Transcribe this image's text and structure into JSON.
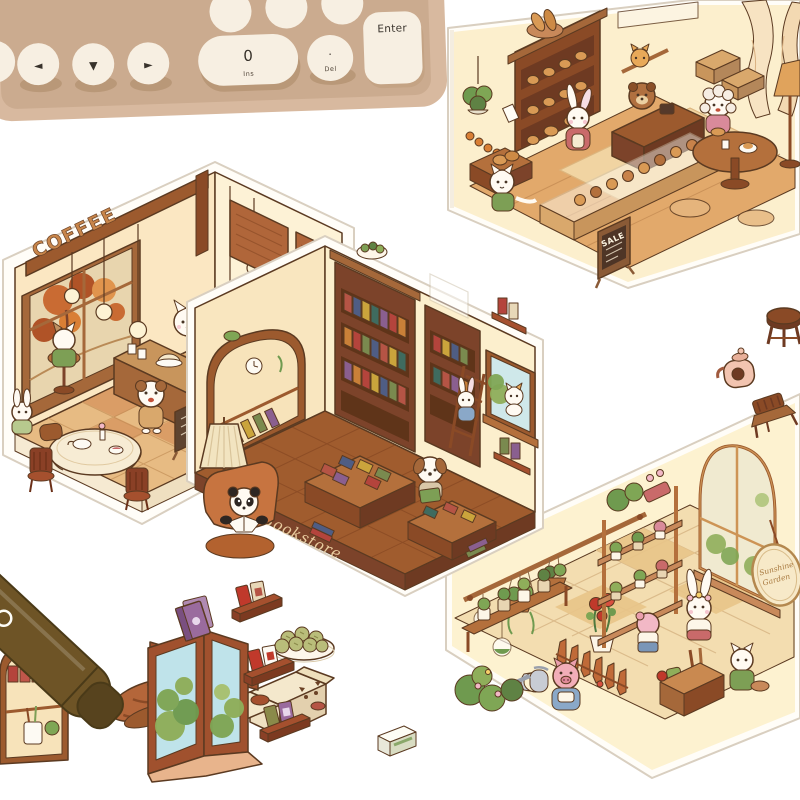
{
  "photo": {
    "background": "#ffffff"
  },
  "keyboard": {
    "body_color": "#d8b99f",
    "key_color": "#f7efe2",
    "arrow_keys": [
      "◄",
      "▼",
      "►"
    ],
    "zero_key": {
      "label": "0",
      "sublabel": "Ins"
    },
    "dot_key": {
      "label": ".",
      "sublabel": "Del"
    },
    "enter_key": {
      "label": "Enter"
    }
  },
  "rooms": {
    "coffee_shop": {
      "sign": "COFFEE",
      "characters": [
        "white cat barista",
        "cat in green sweater",
        "white dog customer",
        "white rabbit at table"
      ],
      "features": [
        "autumn window",
        "hanging bulbs",
        "menu shutters",
        "espresso machine",
        "bar counter",
        "round table with tablecloth",
        "wooden chairs",
        "menu board",
        "potted plant"
      ]
    },
    "bookstore": {
      "sign": "Bookstore",
      "characters": [
        "panda reading in armchair",
        "beagle dog reading",
        "white cat in window",
        "rabbit by ladder"
      ],
      "features": [
        "arched display shelf",
        "pleated floor lamp",
        "bookshelves",
        "succulent bowl",
        "book display tables",
        "window with bush",
        "red wall shelves"
      ]
    },
    "bakery": {
      "board": "SALE",
      "characters": [
        "bear cashier",
        "pink rabbit shopper",
        "white cat clerk",
        "poodle at table",
        "orange cat on shelf"
      ],
      "features": [
        "bread shelves",
        "hanging plant",
        "glass pastry display",
        "round table",
        "curtains",
        "floor lamp",
        "bread crate"
      ]
    },
    "garden_shop": {
      "sign_line1": "Sunshine",
      "sign_line2": "Garden",
      "characters": [
        "pink pig with watering can",
        "white rabbit with flower crown",
        "pink piglet",
        "white cat gardener"
      ],
      "features": [
        "hanging planters",
        "glass terrariums",
        "plant shelves",
        "arched window",
        "oval sign",
        "picket fence",
        "garden crate",
        "rose pot",
        "flowering bushes"
      ]
    }
  },
  "stickers": [
    "marker pen",
    "striped stand",
    "plate of matcha buns",
    "cardboard boxes with cat face",
    "small box",
    "corner window with bushes",
    "purple books",
    "mini book shelf top",
    "mini book shelf middle",
    "mini book shelf bottom",
    "wooden stool",
    "pink teapot",
    "wooden chair",
    "arched stationery cabinet"
  ],
  "palette": {
    "outline": "#5b3a21",
    "wall_cream": "#fcefcd",
    "wood": "#a5683a",
    "wood_dark": "#7c432a",
    "floor_tan": "#e3b077",
    "leaf_green": "#6f9a4f",
    "autumn_orange": "#c96b33",
    "sky_blue": "#bfe3ea",
    "blush_pink": "#f2b8c6",
    "fur_white": "#fffaf2"
  }
}
